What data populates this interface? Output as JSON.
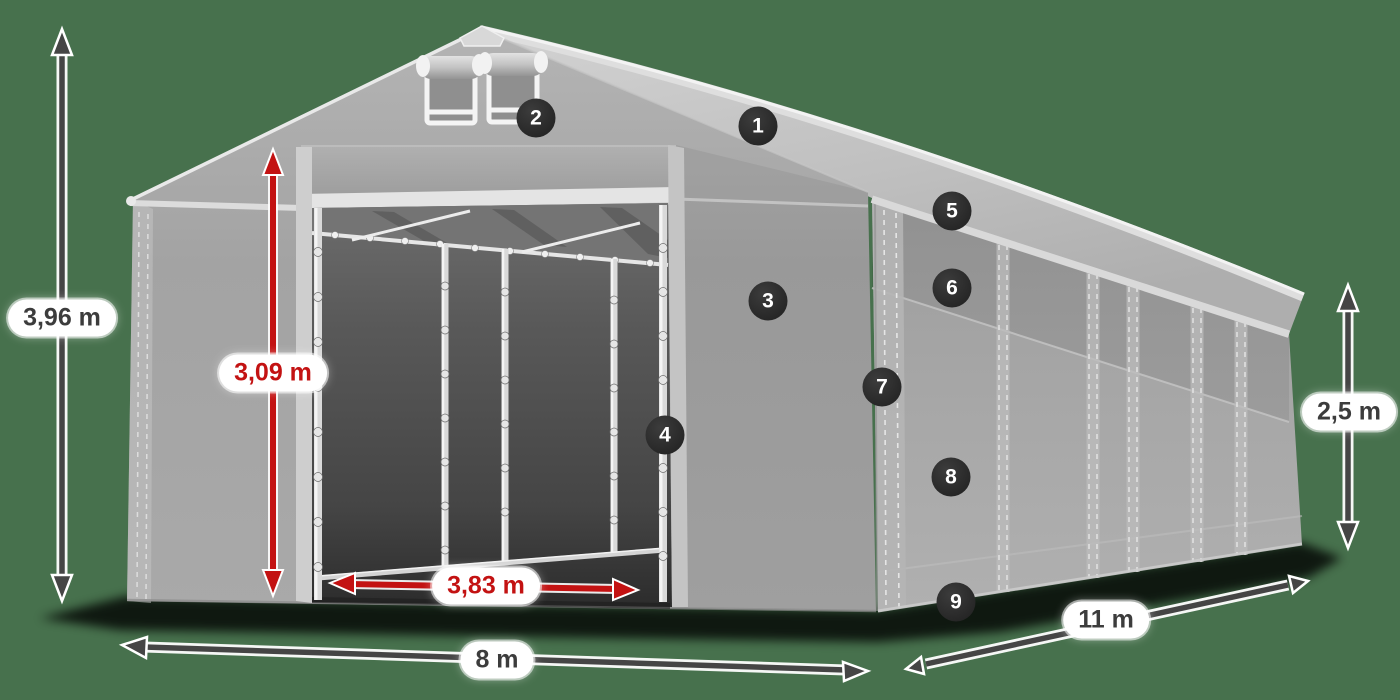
{
  "scene": {
    "description": "Storage tent (marquee) dimensions diagram",
    "background_color": "#47714d",
    "accent_red": "#c31212",
    "arrow_dark": "#454545",
    "badge_color": "#2c2c2c"
  },
  "labels": {
    "total_height": "3,96 m",
    "door_height": "3,09 m",
    "door_width": "3,83 m",
    "front_width": "8 m",
    "side_length": "11 m",
    "side_height": "2,5 m"
  },
  "callouts": [
    {
      "number": "1"
    },
    {
      "number": "2"
    },
    {
      "number": "3"
    },
    {
      "number": "4"
    },
    {
      "number": "5"
    },
    {
      "number": "6"
    },
    {
      "number": "7"
    },
    {
      "number": "8"
    },
    {
      "number": "9"
    }
  ]
}
